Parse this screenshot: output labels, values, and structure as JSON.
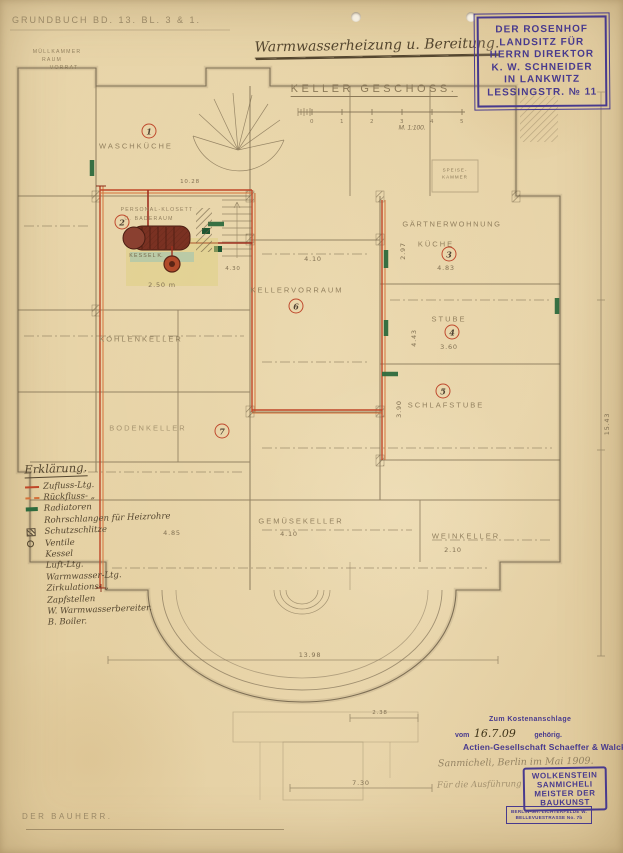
{
  "page": {
    "grundbuch": "Grundbuch Bd. 13. Bl. 3 & 1.",
    "title": "Warmwasserheizung u. Bereitung.",
    "heading": "Keller Geschoss.",
    "scale_label": "M. 1:100.",
    "scale_ticks": [
      "0",
      "1",
      "2",
      "3",
      "4",
      "5"
    ]
  },
  "owner_stamp": {
    "lines": [
      "DER ROSENHOF",
      "LANDSITZ FÜR",
      "HERRN DIREKTOR",
      "K. W. SCHNEIDER",
      "IN LANKWITZ",
      "LESSINGSTR. № 11"
    ]
  },
  "rooms": {
    "muellkammer_1": "Müllkammer",
    "muellkammer_2": "Raum",
    "vorrat": "Vorrat",
    "waschkueche": {
      "label": "Waschküche",
      "number": "1"
    },
    "klosett": {
      "line1": "Personal-Klosett",
      "line2": "u. Baderaum",
      "number": "2"
    },
    "kessel": {
      "label": "Kessel",
      "pump": "K.",
      "dim": "2.50 m",
      "dim_top": "10.28"
    },
    "kellervorraum": {
      "label": "Kellervorraum",
      "number": "6",
      "dim": "4.10",
      "dim2": "4.30"
    },
    "speisekammer": {
      "line1": "Speise-",
      "line2": "Kammer"
    },
    "gaertnerwohnung": {
      "label": "Gärtnerwohnung"
    },
    "kueche": {
      "label": "Küche",
      "number": "3",
      "dim": "4.83",
      "dim_v": "2.97"
    },
    "stube": {
      "label": "Stube",
      "number": "4",
      "dim": "3.60",
      "dim_v": "4.43"
    },
    "schlafstube": {
      "label": "Schlafstube",
      "number": "5",
      "dim_v": "3.90"
    },
    "kohlenkeller": {
      "label": "Kohlenkeller",
      "dim": "4.85"
    },
    "bodenkeller": {
      "label": "Bodenkeller",
      "number": "7"
    },
    "gemuesekeller": {
      "label": "Gemüsekeller",
      "dim": "4.10"
    },
    "weinkeller": {
      "label": "Weinkeller",
      "dim": "2.10"
    }
  },
  "dimensions": {
    "bottom_width": "13.98",
    "right_height": "15.43",
    "porch_width": "2.38",
    "lower_width": "7.30"
  },
  "legend": {
    "heading": "Erklärung.",
    "items": [
      "Zufluss-Ltg.",
      "Rückfluss- „",
      "Radiatoren",
      "Rohrschlangen für Heizrohre",
      "Schutzschlitze",
      "Ventile",
      "Kessel",
      "Luft-Ltg.",
      "Warmwasser-Ltg.",
      "Zirkulations- „",
      "Zapfstellen",
      "W. Warmwasserbereiter.",
      "B. Boiler."
    ]
  },
  "footer": {
    "bauherr": "Der Bauherr.",
    "kosten_line1": "Zum Kostenanschlage",
    "kosten_vom": "vom",
    "kosten_date": "16.7.09",
    "kosten_gehoerig": "gehörig.",
    "company": "Actien-Gesellschaft Schaeffer & Walcker",
    "pencil_note": "Sanmicheli, Berlin im Mai 1909.",
    "pencil_note2": "Für die Ausführung",
    "builder_stamp": [
      "WOLKENSTEIN",
      "SANMICHELI",
      "MEISTER DER",
      "BAUKUNST"
    ],
    "address_stamp": [
      "BERLIN-GR. LICHTERFELDE W.",
      "BELLEVUESTRASSE No. 7b"
    ]
  },
  "colors": {
    "paper": "#e6d2a6",
    "pencil": "#7b6a4e",
    "pipe_supply": "#bf4628",
    "pipe_return": "#d4713a",
    "radiator": "#2e6b3e",
    "stamp_ink": "#483a8e",
    "room_number_ring": "#bf4a2e"
  }
}
